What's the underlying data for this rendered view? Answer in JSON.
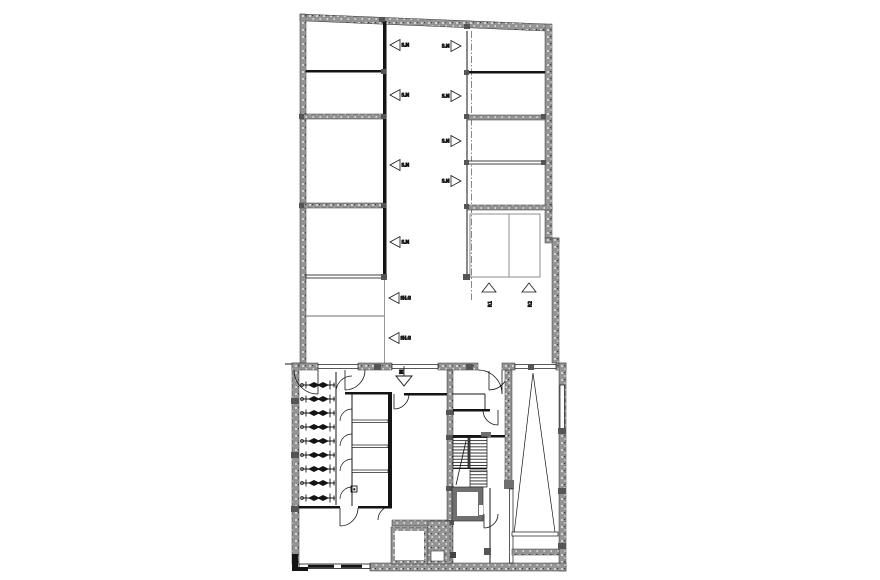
{
  "colors": {
    "background": "#ffffff",
    "line": "#141414",
    "wall_fill": "#949494",
    "wall_dark": "#6f6f6f",
    "thin_gray": "#8c8c8c"
  },
  "upper_plan": {
    "corridor_markers_left": [
      {
        "label": "S.M"
      },
      {
        "label": "S.M"
      },
      {
        "label": "S.M"
      },
      {
        "label": "S.M"
      },
      {
        "label": "SH.G"
      },
      {
        "label": "SH.G"
      }
    ],
    "corridor_markers_right": [
      {
        "label": "S.M"
      },
      {
        "label": "S.M"
      },
      {
        "label": "S.M"
      },
      {
        "label": "S.M"
      }
    ],
    "parking_markers": [
      {
        "label": "P.1"
      },
      {
        "label": "P.2"
      }
    ]
  },
  "lower_plan": {
    "entrance_marker": {
      "label": "IN"
    },
    "bicycle_count": 9
  }
}
